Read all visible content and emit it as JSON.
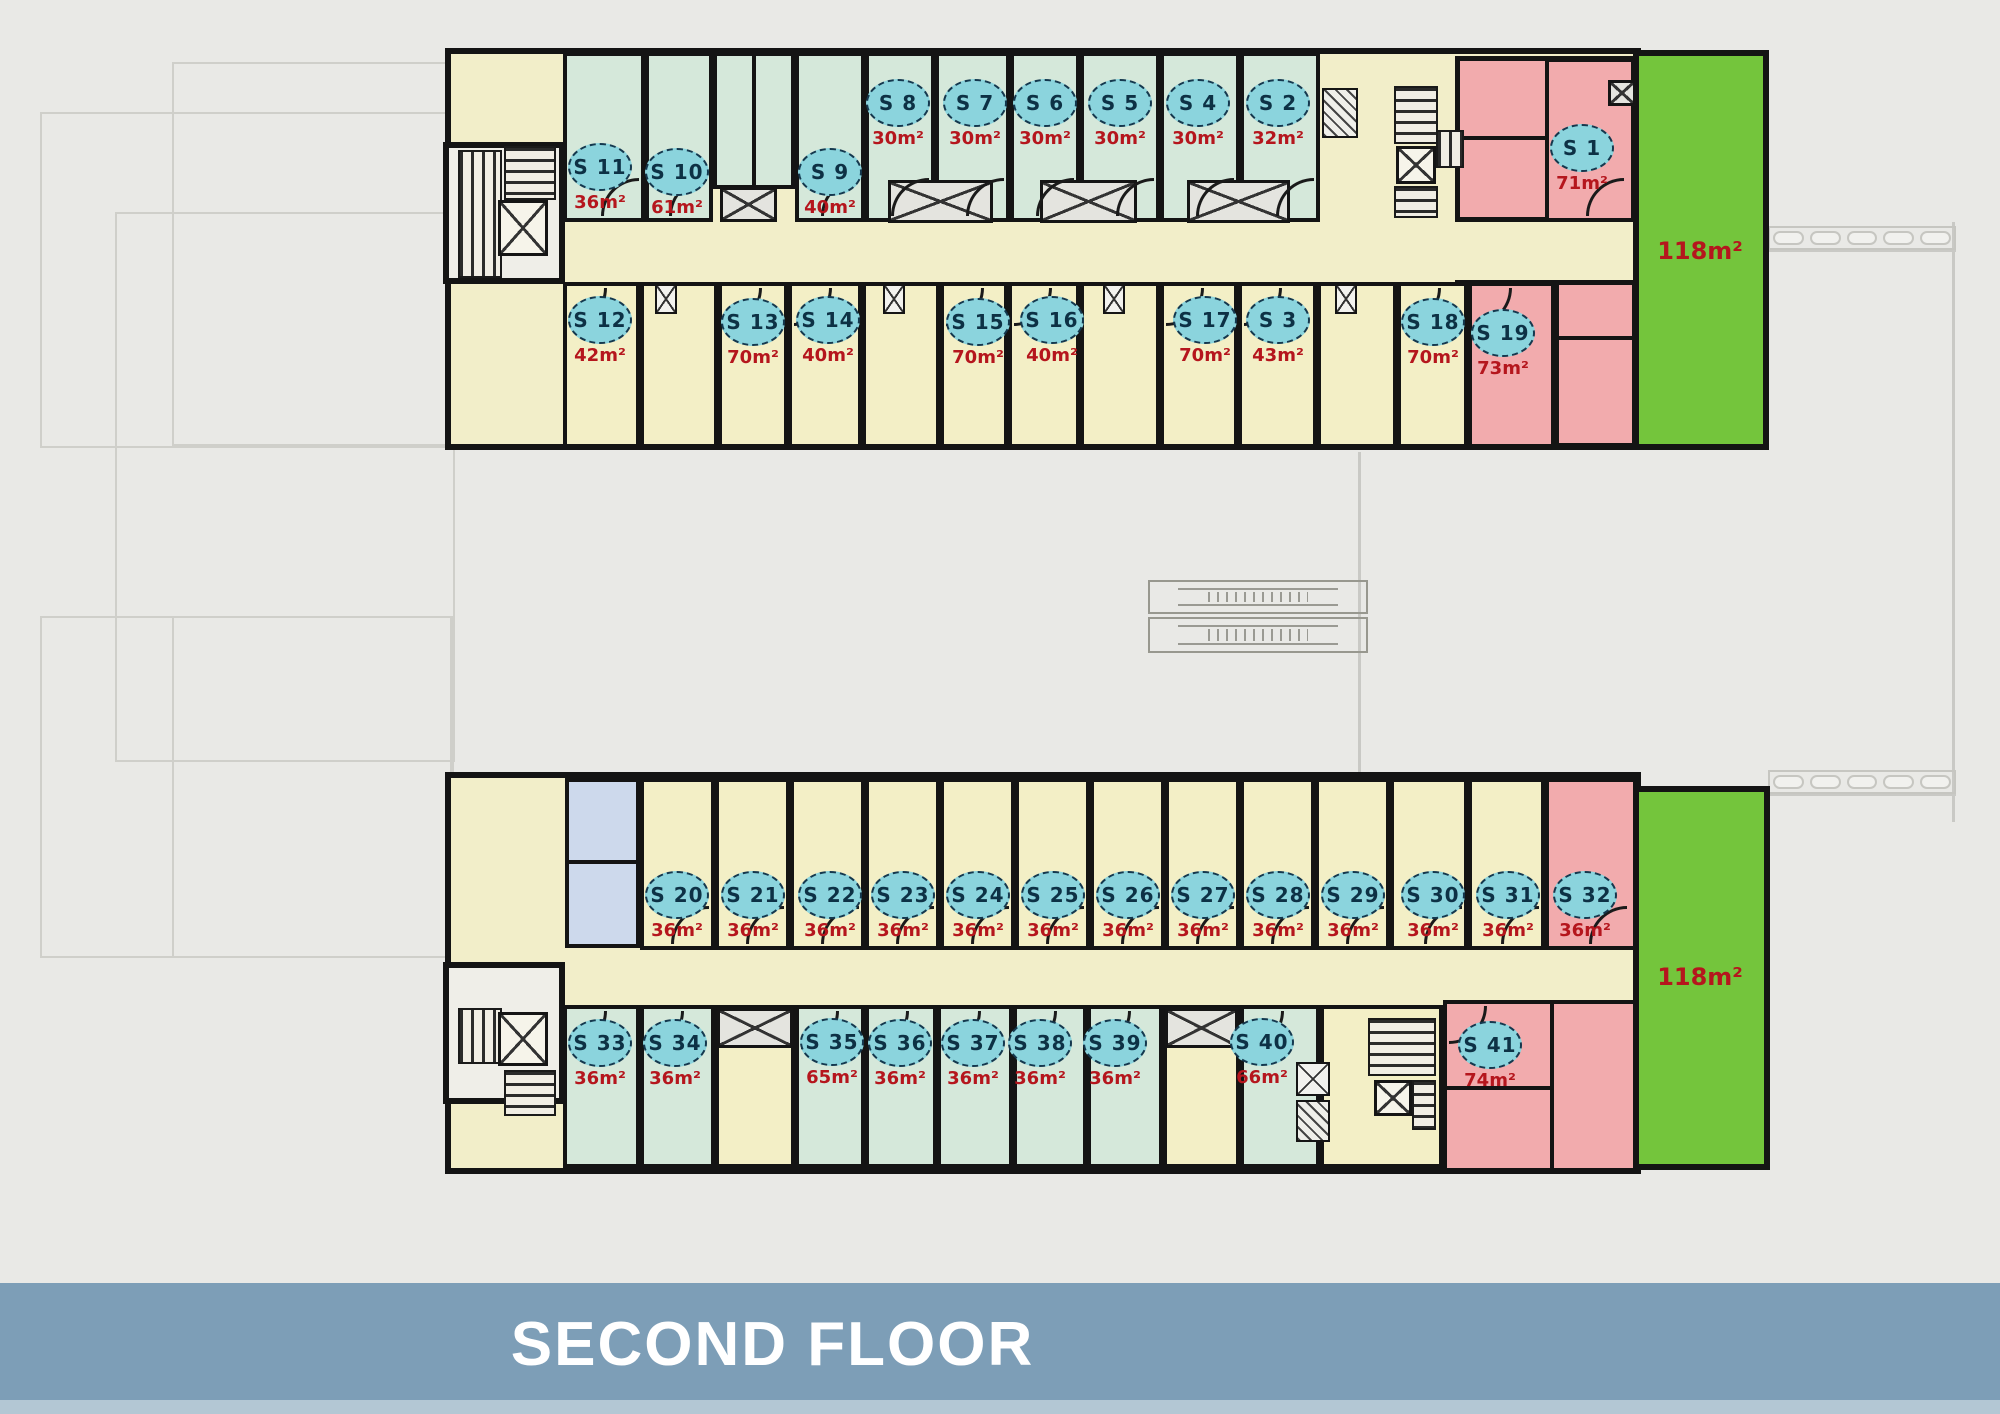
{
  "title": "SECOND FLOOR",
  "colors": {
    "background": "#e9e9e6",
    "wall": "#141414",
    "room_mint": "#d5e8da",
    "room_yellow": "#f3efc6",
    "room_pink": "#f2abad",
    "room_blue": "#cdd9ec",
    "corridor": "#f2eec9",
    "white": "#efeee8",
    "terrace_green": "#74c53c",
    "tag_fill": "#8bd4dd",
    "tag_border": "#14384e",
    "tag_text": "#0d3145",
    "area_text": "#b5161d",
    "banner": "#7d9eb7",
    "banner_strip": "#b3c7d4",
    "ghost": "#cfcfca"
  },
  "units": [
    {
      "label": "S 11",
      "area": "36m²",
      "cx": 600,
      "cy": 167,
      "room": [
        563,
        52,
        82,
        170
      ],
      "fill": "mint",
      "door": "b"
    },
    {
      "label": "S 10",
      "area": "61m²",
      "cx": 677,
      "cy": 172,
      "room": [
        645,
        52,
        68,
        170
      ],
      "fill": "mint",
      "door": "b"
    },
    {
      "label": "S 9",
      "area": "40m²",
      "cx": 830,
      "cy": 172,
      "room": [
        795,
        52,
        70,
        170
      ],
      "fill": "mint",
      "door": "b"
    },
    {
      "label": "S 8",
      "area": "30m²",
      "cx": 898,
      "cy": 103,
      "room": [
        865,
        52,
        70,
        170
      ],
      "fill": "mint",
      "door": "b"
    },
    {
      "label": "S 7",
      "area": "30m²",
      "cx": 975,
      "cy": 103,
      "room": [
        935,
        52,
        75,
        170
      ],
      "fill": "mint",
      "door": "b"
    },
    {
      "label": "S 6",
      "area": "30m²",
      "cx": 1045,
      "cy": 103,
      "room": [
        1010,
        52,
        70,
        170
      ],
      "fill": "mint",
      "door": "b"
    },
    {
      "label": "S 5",
      "area": "30m²",
      "cx": 1120,
      "cy": 103,
      "room": [
        1080,
        52,
        80,
        170
      ],
      "fill": "mint",
      "door": "b"
    },
    {
      "label": "S 4",
      "area": "30m²",
      "cx": 1198,
      "cy": 103,
      "room": [
        1160,
        52,
        80,
        170
      ],
      "fill": "mint",
      "door": "b"
    },
    {
      "label": "S 2",
      "area": "32m²",
      "cx": 1278,
      "cy": 103,
      "room": [
        1240,
        52,
        80,
        170
      ],
      "fill": "mint",
      "door": "b"
    },
    {
      "label": "S 12",
      "area": "42m²",
      "cx": 600,
      "cy": 320,
      "room": [
        563,
        282,
        77,
        166
      ],
      "fill": "yellow",
      "door": "t"
    },
    {
      "label": "S 13",
      "area": "70m²",
      "cx": 753,
      "cy": 322,
      "room": [
        718,
        282,
        70,
        166
      ],
      "fill": "yellow",
      "door": "t"
    },
    {
      "label": "S 14",
      "area": "40m²",
      "cx": 828,
      "cy": 320,
      "room": [
        788,
        282,
        74,
        166
      ],
      "fill": "yellow",
      "door": "t"
    },
    {
      "label": "S 15",
      "area": "70m²",
      "cx": 978,
      "cy": 322,
      "room": [
        940,
        282,
        68,
        166
      ],
      "fill": "yellow",
      "door": "t"
    },
    {
      "label": "S 16",
      "area": "40m²",
      "cx": 1052,
      "cy": 320,
      "room": [
        1008,
        282,
        72,
        166
      ],
      "fill": "yellow",
      "door": "t"
    },
    {
      "label": "S 17",
      "area": "70m²",
      "cx": 1205,
      "cy": 320,
      "room": [
        1160,
        282,
        78,
        166
      ],
      "fill": "yellow",
      "door": "t"
    },
    {
      "label": "S 3",
      "area": "43m²",
      "cx": 1278,
      "cy": 320,
      "room": [
        1238,
        282,
        79,
        166
      ],
      "fill": "yellow",
      "door": "t"
    },
    {
      "label": "S 18",
      "area": "70m²",
      "cx": 1433,
      "cy": 322,
      "room": [
        1397,
        282,
        71,
        166
      ],
      "fill": "yellow",
      "door": "t"
    },
    {
      "label": "S 19",
      "area": "73m²",
      "cx": 1503,
      "cy": 333,
      "room": [
        1468,
        282,
        87,
        166
      ],
      "fill": "pink",
      "door": "t"
    },
    {
      "label": "S 1",
      "area": "71m²",
      "cx": 1582,
      "cy": 148,
      "room": [
        1545,
        58,
        90,
        164
      ],
      "fill": "pink",
      "door": "b"
    },
    {
      "label": "S 20",
      "area": "36m²",
      "cx": 677,
      "cy": 895,
      "room": [
        640,
        778,
        75,
        172
      ],
      "fill": "yellow",
      "door": "b"
    },
    {
      "label": "S 21",
      "area": "36m²",
      "cx": 753,
      "cy": 895,
      "room": [
        715,
        778,
        75,
        172
      ],
      "fill": "yellow",
      "door": "b"
    },
    {
      "label": "S 22",
      "area": "36m²",
      "cx": 830,
      "cy": 895,
      "room": [
        790,
        778,
        75,
        172
      ],
      "fill": "yellow",
      "door": "b"
    },
    {
      "label": "S 23",
      "area": "36m²",
      "cx": 903,
      "cy": 895,
      "room": [
        865,
        778,
        75,
        172
      ],
      "fill": "yellow",
      "door": "b"
    },
    {
      "label": "S 24",
      "area": "36m²",
      "cx": 978,
      "cy": 895,
      "room": [
        940,
        778,
        75,
        172
      ],
      "fill": "yellow",
      "door": "b"
    },
    {
      "label": "S 25",
      "area": "36m²",
      "cx": 1053,
      "cy": 895,
      "room": [
        1015,
        778,
        75,
        172
      ],
      "fill": "yellow",
      "door": "b"
    },
    {
      "label": "S 26",
      "area": "36m²",
      "cx": 1128,
      "cy": 895,
      "room": [
        1090,
        778,
        75,
        172
      ],
      "fill": "yellow",
      "door": "b"
    },
    {
      "label": "S 27",
      "area": "36m²",
      "cx": 1203,
      "cy": 895,
      "room": [
        1165,
        778,
        75,
        172
      ],
      "fill": "yellow",
      "door": "b"
    },
    {
      "label": "S 28",
      "area": "36m²",
      "cx": 1278,
      "cy": 895,
      "room": [
        1240,
        778,
        75,
        172
      ],
      "fill": "yellow",
      "door": "b"
    },
    {
      "label": "S 29",
      "area": "36m²",
      "cx": 1353,
      "cy": 895,
      "room": [
        1315,
        778,
        75,
        172
      ],
      "fill": "yellow",
      "door": "b"
    },
    {
      "label": "S 30",
      "area": "36m²",
      "cx": 1433,
      "cy": 895,
      "room": [
        1390,
        778,
        78,
        172
      ],
      "fill": "yellow",
      "door": "b"
    },
    {
      "label": "S 31",
      "area": "36m²",
      "cx": 1508,
      "cy": 895,
      "room": [
        1468,
        778,
        77,
        172
      ],
      "fill": "yellow",
      "door": "b"
    },
    {
      "label": "S 32",
      "area": "36m²",
      "cx": 1585,
      "cy": 895,
      "room": [
        1545,
        778,
        92,
        172
      ],
      "fill": "pink",
      "door": "b"
    },
    {
      "label": "S 33",
      "area": "36m²",
      "cx": 600,
      "cy": 1043,
      "room": [
        563,
        1005,
        77,
        163
      ],
      "fill": "mint",
      "door": "t"
    },
    {
      "label": "S 34",
      "area": "36m²",
      "cx": 675,
      "cy": 1043,
      "room": [
        640,
        1005,
        75,
        163
      ],
      "fill": "mint",
      "door": "t"
    },
    {
      "label": "S 35",
      "area": "65m²",
      "cx": 832,
      "cy": 1042,
      "room": [
        795,
        1005,
        70,
        163
      ],
      "fill": "mint",
      "door": "t"
    },
    {
      "label": "S 36",
      "area": "36m²",
      "cx": 900,
      "cy": 1043,
      "room": [
        865,
        1005,
        72,
        163
      ],
      "fill": "mint",
      "door": "t"
    },
    {
      "label": "S 37",
      "area": "36m²",
      "cx": 973,
      "cy": 1043,
      "room": [
        937,
        1005,
        76,
        163
      ],
      "fill": "mint",
      "door": "t"
    },
    {
      "label": "S 38",
      "area": "36m²",
      "cx": 1040,
      "cy": 1043,
      "room": [
        1013,
        1005,
        74,
        163
      ],
      "fill": "mint",
      "door": "t"
    },
    {
      "label": "S 39",
      "area": "36m²",
      "cx": 1115,
      "cy": 1043,
      "room": [
        1087,
        1005,
        76,
        163
      ],
      "fill": "mint",
      "door": "t"
    },
    {
      "label": "S 40",
      "area": "66m²",
      "cx": 1262,
      "cy": 1042,
      "room": [
        1240,
        1005,
        80,
        163
      ],
      "fill": "mint",
      "door": "t"
    },
    {
      "label": "S 41",
      "area": "74m²",
      "cx": 1490,
      "cy": 1045,
      "room": [
        1443,
        1000,
        194,
        172
      ],
      "fill": "pink",
      "door": "t"
    }
  ],
  "terraces": [
    {
      "area": "118m²",
      "rect": [
        1633,
        50,
        136,
        400
      ],
      "label_x": 1700,
      "label_y": 252
    },
    {
      "area": "118m²",
      "rect": [
        1633,
        786,
        137,
        384
      ],
      "label_x": 1700,
      "label_y": 978
    }
  ],
  "zones": [
    {
      "r": [
        445,
        48,
        1196,
        402
      ],
      "fill": "corridor",
      "bw": 6,
      "name": "building-top-shell"
    },
    {
      "r": [
        443,
        142,
        122,
        142
      ],
      "fill": "white",
      "bw": 6,
      "name": "building-top-stair-wing"
    },
    {
      "r": [
        1455,
        56,
        182,
        166
      ],
      "fill": "pink",
      "bw": 5,
      "name": "building-top-pink-upper"
    },
    {
      "r": [
        1455,
        280,
        182,
        168
      ],
      "fill": "pink",
      "bw": 5,
      "name": "building-top-pink-lower"
    },
    {
      "r": [
        713,
        52,
        82,
        137
      ],
      "fill": "mint",
      "bw": 4,
      "name": "building-top-bath-pod"
    },
    {
      "r": [
        640,
        282,
        78,
        166
      ],
      "fill": "yellow",
      "bw": 4,
      "name": "utility-zone"
    },
    {
      "r": [
        862,
        282,
        78,
        166
      ],
      "fill": "yellow",
      "bw": 4,
      "name": "utility-zone"
    },
    {
      "r": [
        1080,
        282,
        80,
        166
      ],
      "fill": "yellow",
      "bw": 4,
      "name": "utility-zone"
    },
    {
      "r": [
        1317,
        282,
        80,
        166
      ],
      "fill": "yellow",
      "bw": 4,
      "name": "utility-zone"
    },
    {
      "r": [
        445,
        772,
        1196,
        402
      ],
      "fill": "corridor",
      "bw": 6,
      "name": "building-bottom-shell"
    },
    {
      "r": [
        443,
        962,
        122,
        142
      ],
      "fill": "white",
      "bw": 6,
      "name": "building-bottom-stair-wing"
    },
    {
      "r": [
        565,
        778,
        75,
        170
      ],
      "fill": "blue",
      "bw": 4,
      "name": "wc-zone"
    },
    {
      "r": [
        715,
        1005,
        80,
        163
      ],
      "fill": "yellow",
      "bw": 4,
      "name": "utility-zone"
    },
    {
      "r": [
        1163,
        1005,
        77,
        163
      ],
      "fill": "yellow",
      "bw": 4,
      "name": "utility-zone"
    },
    {
      "r": [
        1320,
        1005,
        123,
        163
      ],
      "fill": "yellow",
      "bw": 4,
      "name": "utility-zone"
    }
  ],
  "features": {
    "stairs_v": [
      [
        504,
        146,
        52,
        54
      ],
      [
        1394,
        86,
        44,
        58
      ],
      [
        1394,
        186,
        44,
        32
      ],
      [
        504,
        1070,
        52,
        46
      ],
      [
        1368,
        1018,
        68,
        58
      ],
      [
        1412,
        1080,
        24,
        50
      ]
    ],
    "stairs_h": [
      [
        458,
        150,
        44,
        128
      ],
      [
        1436,
        130,
        28,
        38
      ],
      [
        458,
        1008,
        44,
        56
      ]
    ],
    "elevators": [
      [
        498,
        200,
        50,
        56
      ],
      [
        1396,
        146,
        40,
        38
      ],
      [
        498,
        1012,
        50,
        54
      ],
      [
        1374,
        1080,
        38,
        36
      ]
    ],
    "shafts": [
      [
        720,
        187,
        57,
        35
      ],
      [
        888,
        180,
        105,
        43
      ],
      [
        1040,
        180,
        97,
        43
      ],
      [
        1187,
        180,
        103,
        43
      ],
      [
        717,
        1008,
        76,
        40
      ],
      [
        1165,
        1008,
        73,
        40
      ],
      [
        1608,
        80,
        28,
        26
      ]
    ],
    "small_shafts": [
      [
        655,
        284,
        22,
        30
      ],
      [
        883,
        284,
        22,
        30
      ],
      [
        1103,
        284,
        22,
        30
      ],
      [
        1335,
        284,
        22,
        30
      ],
      [
        1296,
        1062,
        34,
        34
      ]
    ],
    "ducts": [
      [
        1322,
        88,
        36,
        50
      ],
      [
        1296,
        1100,
        34,
        42
      ]
    ],
    "escalators": [
      [
        1148,
        580,
        220,
        34
      ],
      [
        1148,
        617,
        220,
        36
      ]
    ],
    "walls": [
      [
        1459,
        136,
        86,
        4
      ],
      [
        1555,
        284,
        4,
        164
      ],
      [
        1555,
        336,
        82,
        4
      ],
      [
        1550,
        1004,
        4,
        166
      ],
      [
        1447,
        1086,
        103,
        4
      ],
      [
        567,
        860,
        73,
        4
      ],
      [
        752,
        52,
        4,
        137
      ]
    ],
    "slat_rows": [
      [
        1768,
        226,
        188,
        24
      ],
      [
        1768,
        770,
        188,
        24
      ]
    ],
    "ghost_rects": [
      [
        40,
        112,
        412,
        336
      ],
      [
        172,
        62,
        282,
        384
      ],
      [
        115,
        212,
        340,
        550
      ],
      [
        40,
        616,
        412,
        342
      ],
      [
        172,
        616,
        282,
        342
      ]
    ],
    "ghost_lines": [
      [
        1358,
        452,
        3,
        320
      ],
      [
        1952,
        222,
        3,
        600
      ],
      [
        1768,
        250,
        188,
        2
      ],
      [
        1768,
        794,
        188,
        2
      ]
    ]
  }
}
